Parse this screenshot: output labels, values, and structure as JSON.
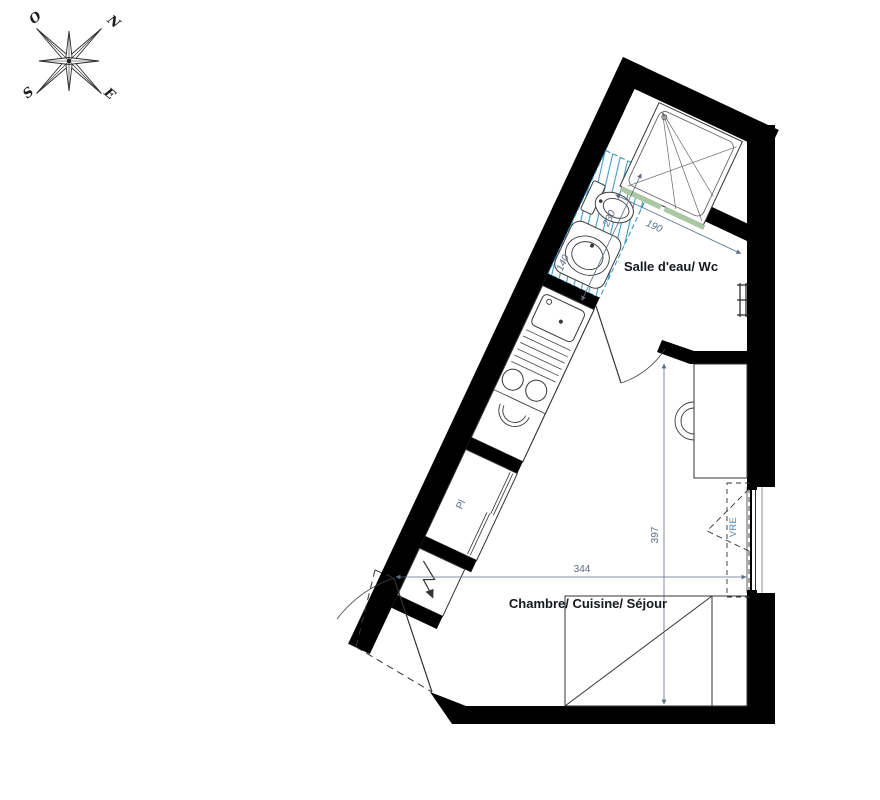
{
  "compass": {
    "west": "O",
    "north": "N",
    "south": "S",
    "east": "E"
  },
  "labels": {
    "bathroom": "Salle d'eau/ Wc",
    "main_room": "Chambre/ Cuisine/ Séjour",
    "closet": "Pl",
    "shutter": "VRE"
  },
  "dimensions": {
    "shower_width": "190",
    "bathroom_length": "230",
    "pod_width": "140",
    "room_length": "397",
    "room_width": "344"
  },
  "colors": {
    "wall": "#000000",
    "pod_hatch": "#3d9ccd",
    "pod_outline": "#2e8fc0",
    "shower_screen": "#a9c8a2",
    "dim_text": "#5a6b85",
    "room_label": "#14171c",
    "closet_label": "#4a6f9a",
    "shutter_label": "#4a7fb5"
  },
  "fixtures": [
    "compass-rose",
    "shower-tray",
    "wc",
    "washbasin",
    "kitchen-sink",
    "cooktop",
    "closet-sliding-door",
    "electrical-panel",
    "entrance-door",
    "bathroom-door",
    "french-window",
    "radiator",
    "bed",
    "desk",
    "chair"
  ]
}
